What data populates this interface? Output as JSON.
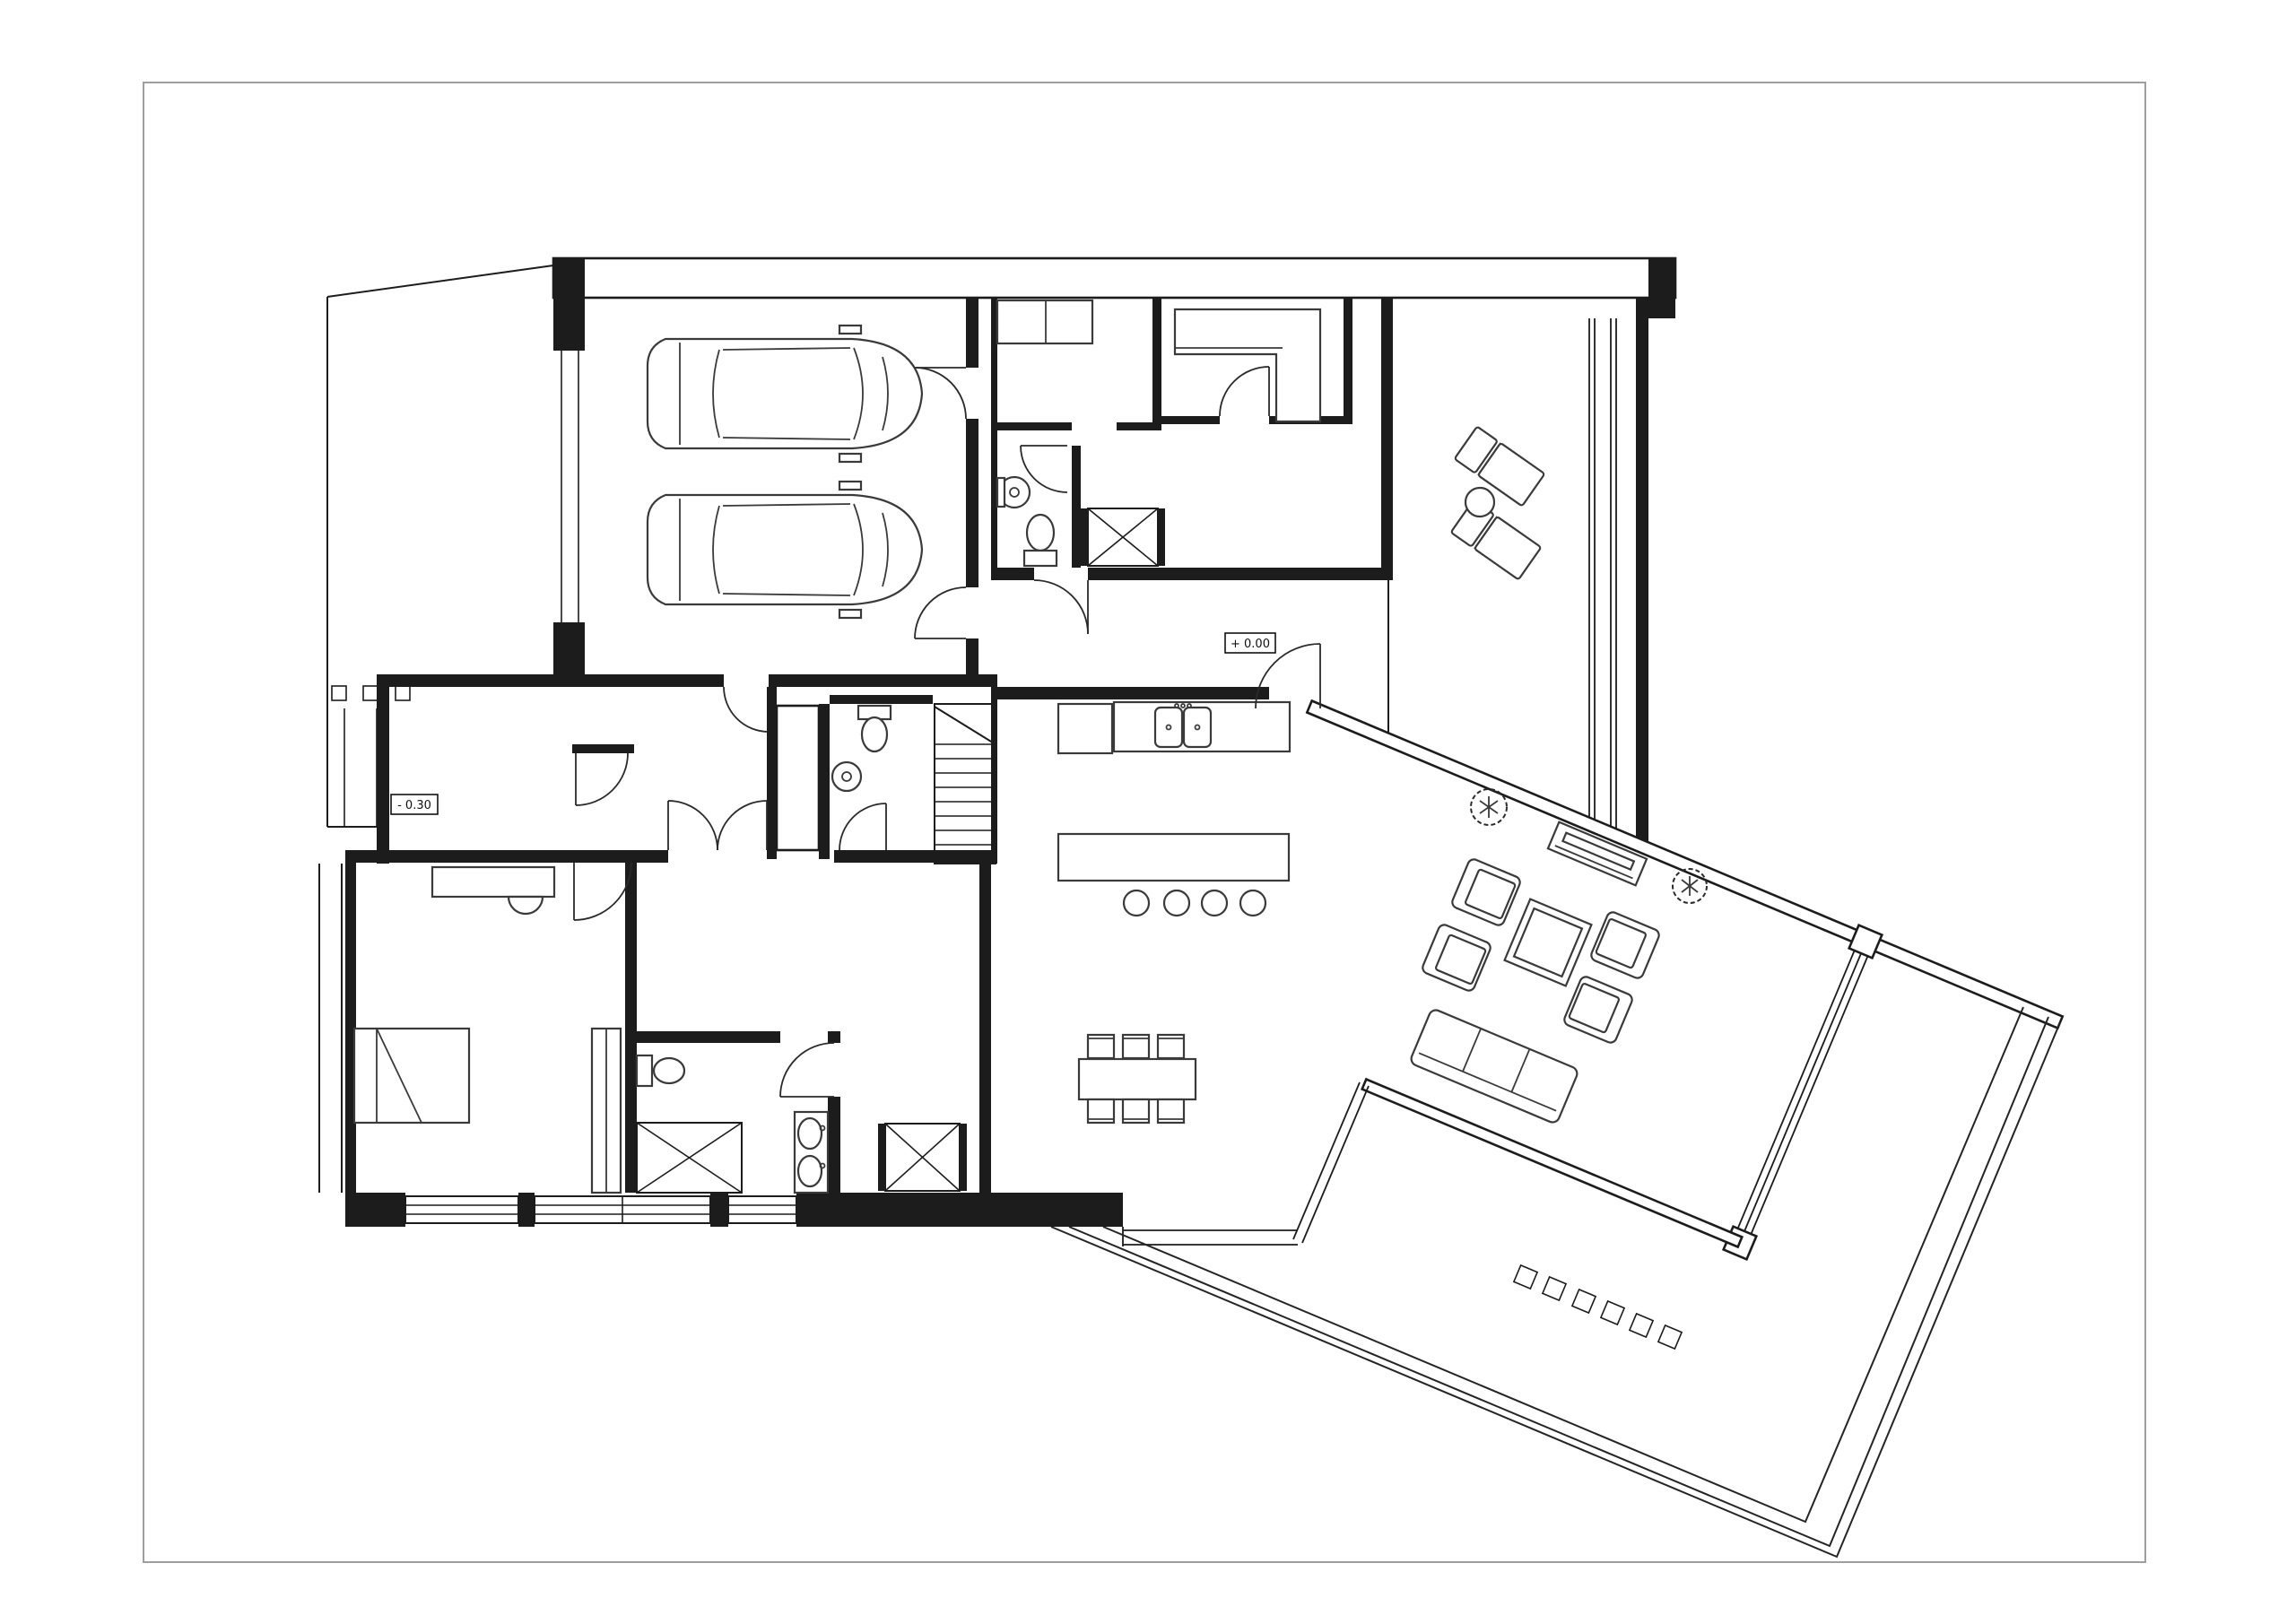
{
  "document": {
    "kind": "architectural-floor-plan",
    "view": "ground floor plan, top view",
    "style": "black CAD line drawing on white sheet"
  },
  "labels": {
    "elevation_main": "+ 0.00",
    "elevation_entry": "- 0.30"
  },
  "colors": {
    "paper": "#ffffff",
    "line": "#1c1c1c",
    "furniture_line": "#3a3a3a",
    "sheet_border": "#9e9e9e"
  },
  "rooms": [
    {
      "name": "garage",
      "features": [
        "two parked cars",
        "window in west wall",
        "two doors to house"
      ]
    },
    {
      "name": "storage-room",
      "features": [
        "counter with split top"
      ]
    },
    {
      "name": "mudroom",
      "features": [
        "L-shaped bench"
      ]
    },
    {
      "name": "wc-upper",
      "features": [
        "toilet",
        "round washbasin"
      ]
    },
    {
      "name": "closet-upper",
      "features": [
        "wardrobe with X symbol"
      ]
    },
    {
      "name": "hall",
      "features": [
        "elevation marker + 0.00",
        "doors to terrace and living area"
      ]
    },
    {
      "name": "staircase",
      "features": [
        "9 treads",
        "diagonal break line"
      ]
    },
    {
      "name": "wc-stairs",
      "features": [
        "toilet",
        "round washbasin"
      ]
    },
    {
      "name": "kitchen",
      "features": [
        "counter with double sink",
        "island",
        "4 bar stools"
      ]
    },
    {
      "name": "dining-area",
      "features": [
        "table with 6 chairs",
        "glass south wall"
      ]
    },
    {
      "name": "living-room-rotated-wing",
      "features": [
        "sofa",
        "4 armchairs",
        "coffee table",
        "fireplace",
        "glazed walls"
      ]
    },
    {
      "name": "sun-terrace",
      "features": [
        "2 sun loungers",
        "round side table"
      ]
    },
    {
      "name": "wrap-around-terrace",
      "features": [
        "rotated deck bands",
        "6 square planters"
      ]
    },
    {
      "name": "foyer",
      "features": [
        "double swing doors",
        "closet"
      ]
    },
    {
      "name": "bedroom",
      "features": [
        "double bed",
        "desk with chair",
        "tall wardrobe"
      ]
    },
    {
      "name": "bathroom",
      "features": [
        "shower with X",
        "toilet",
        "vanity with 2 oval basins"
      ]
    },
    {
      "name": "entry-porch",
      "features": [
        "elevation marker - 0.30",
        "3 fence posts"
      ]
    }
  ],
  "furniture_counts": {
    "cars": 2,
    "sun_loungers": 2,
    "side_tables": 1,
    "sofas": 1,
    "armchairs": 4,
    "coffee_tables": 1,
    "fireplaces": 1,
    "trees": 2,
    "dining_chairs": 6,
    "dining_tables": 1,
    "bar_stools": 4,
    "beds": 1,
    "desks": 1,
    "wardrobes": 3,
    "toilets": 3,
    "round_basins": 2,
    "oval_basins": 2,
    "kitchen_sink_bowls": 2,
    "showers": 1,
    "terrace_planters": 6,
    "fence_posts": 3
  }
}
